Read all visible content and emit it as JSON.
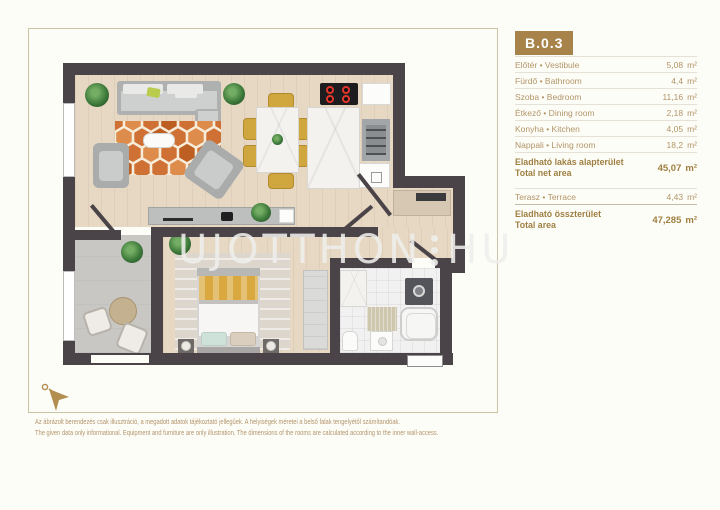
{
  "unit": {
    "id": "B.0.3"
  },
  "table": {
    "rooms": [
      {
        "label": "Előtér • Vestibule",
        "value": "5,08",
        "unit": "m²"
      },
      {
        "label": "Fürdő • Bathroom",
        "value": "4,4",
        "unit": "m²"
      },
      {
        "label": "Szoba • Bedroom",
        "value": "11,16",
        "unit": "m²"
      },
      {
        "label": "Étkező • Dining room",
        "value": "2,18",
        "unit": "m²"
      },
      {
        "label": "Konyha • Kitchen",
        "value": "4,05",
        "unit": "m²"
      },
      {
        "label": "Nappali • Living room",
        "value": "18,2",
        "unit": "m²"
      }
    ],
    "net": {
      "label_hu": "Eladható lakás alapterület",
      "label_en": "Total net area",
      "value": "45,07",
      "unit": "m²"
    },
    "terrace": {
      "label": "Terasz • Terrace",
      "value": "4,43",
      "unit": "m²"
    },
    "total": {
      "label_hu": "Eladható összterület",
      "label_en": "Total area",
      "value": "47,285",
      "unit": "m²"
    }
  },
  "watermark": {
    "left": "UJOTTHON",
    "right": "HU"
  },
  "disclaimer": {
    "hu": "Az ábrázolt berendezés csak illusztráció, a megadott adatok tájékoztató jellegűek. A helyiségek méretei a belső falak tengelyétől számítandóak.",
    "en": "The given data only informational. Equipment and furniture are only illustration. The dimensions of the rooms are calculated according to the inner wall-access."
  },
  "colors": {
    "accent_gold": "#a7834a",
    "text_tan": "#b29467",
    "wall_dark": "#4a4347",
    "rug_orange": "#cf7034",
    "chair_mustard": "#d0a63e"
  }
}
